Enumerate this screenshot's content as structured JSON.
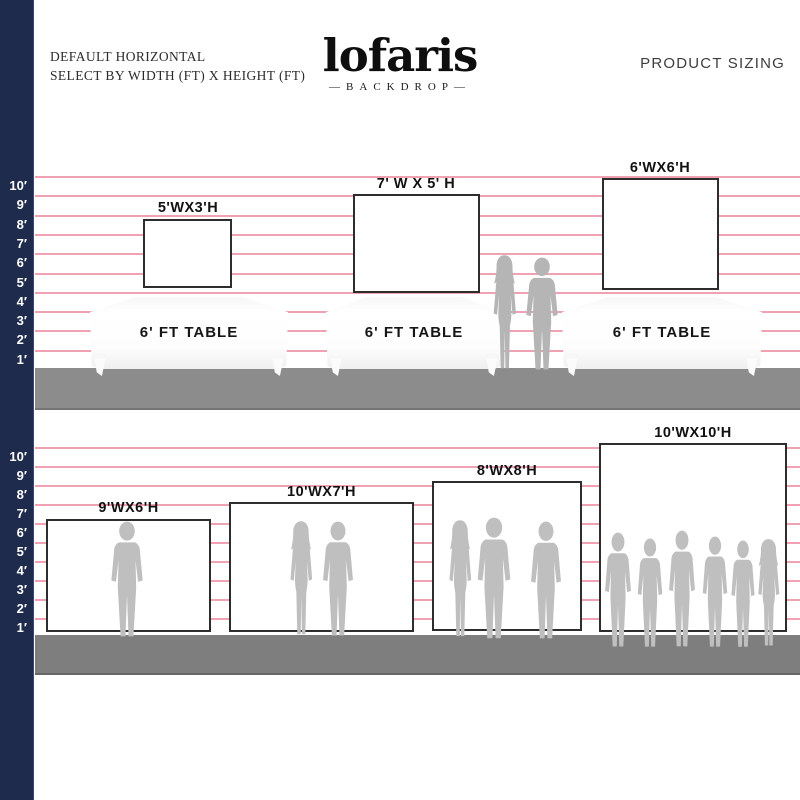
{
  "header": {
    "left_line1": "DEFAULT HORIZONTAL",
    "left_line2": "SELECT BY WIDTH (FT) X HEIGHT (FT)",
    "logo_title": "lofaris",
    "logo_subtitle": "—BACKDROP—",
    "right_title": "PRODUCT SIZING"
  },
  "ruler": {
    "labels": [
      "10′",
      "9′",
      "8′",
      "7′",
      "6′",
      "5′",
      "4′",
      "3′",
      "2′",
      "1′"
    ]
  },
  "top_row": {
    "items": [
      {
        "size_label": "5'WX3'H",
        "table_label": "6' FT TABLE"
      },
      {
        "size_label": "7' W X 5' H",
        "table_label": "6' FT TABLE"
      },
      {
        "size_label": "6'WX6'H",
        "table_label": "6' FT TABLE"
      }
    ],
    "figures": "couple standing between second and third table"
  },
  "bottom_row": {
    "items": [
      {
        "size_label": "9'WX6'H",
        "people": 1
      },
      {
        "size_label": "10'WX7'H",
        "people": 2
      },
      {
        "size_label": "8'WX8'H",
        "people": 3
      },
      {
        "size_label": "10'WX10'H",
        "people": 6
      }
    ]
  },
  "colors": {
    "navy_bar": "#1e2b4d",
    "grid_line_pink": "#ef9aab",
    "floor_top": "#8c8c8c",
    "floor_bottom": "#7e7e7e",
    "silhouette_gray": "#bfbfbf",
    "backdrop_border": "#2d2d2d",
    "text": "#111111"
  }
}
